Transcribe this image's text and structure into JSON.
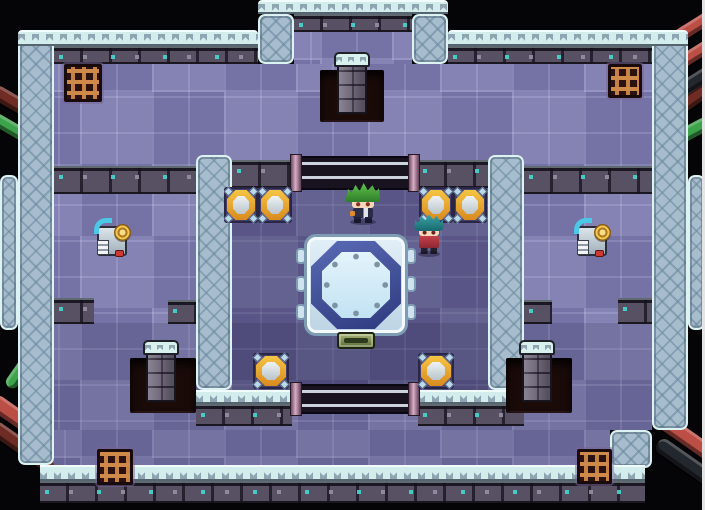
{
  "meta": {
    "width": 705,
    "height": 510
  },
  "palette": {
    "bg": "#050508",
    "wallBase": "#a7bdcd",
    "wallEdge": "#ddf2f2",
    "capBase": "#d3ecec",
    "capZig": "#8fa5b2",
    "trimBase": "#575163",
    "trimTeal": "#45d8cf",
    "trimChip": "#968fa5",
    "floorBase": "#7f7db1",
    "innerTint": "rgba(28,22,64,0.30)",
    "hallTint": "rgba(24,18,58,0.14)",
    "pillarCap": "#d8f0ee",
    "grateBar": "#cf8a4a",
    "railLine": "#ccd2de",
    "railEnd": "#d9aec6",
    "machineTube": "#49c8e8",
    "machineRed": "#cb3a33",
    "charGreenHair": "#5fc24a",
    "charTealHair": "#3fa8aa",
    "charSkin": "#f6d7b8",
    "charNavy": "#2c2c46",
    "charRed": "#c24049",
    "charOrange": "#e08a2e",
    "pipeGreen": "#3da34b",
    "pipeRed": "#bb4f46",
    "pipeRedDark": "#6e2c24",
    "pipeBlack": "#23272e"
  },
  "scene": {
    "entities": [
      {
        "name": "pipe-top-left-dark-red",
        "type": "pipe",
        "x": -12,
        "y": 100,
        "w": 70,
        "h": 15,
        "rot": 30,
        "color": "pipeRedDark",
        "inter": false
      },
      {
        "name": "pipe-top-left-green",
        "type": "pipe",
        "x": -12,
        "y": 126,
        "w": 62,
        "h": 13,
        "rot": 30,
        "color": "pipeGreen",
        "inter": false
      },
      {
        "name": "pipe-right-dark-red",
        "type": "pipe",
        "x": 650,
        "y": 95,
        "w": 70,
        "h": 16,
        "rot": -35,
        "color": "pipeRedDark",
        "inter": false
      },
      {
        "name": "pipe-right-green",
        "type": "pipe",
        "x": 664,
        "y": 126,
        "w": 48,
        "h": 14,
        "rot": -28,
        "color": "pipeGreen",
        "inter": false
      },
      {
        "name": "pipe-top-right-red-1",
        "type": "pipe",
        "x": 666,
        "y": 18,
        "w": 62,
        "h": 13,
        "rot": -32,
        "color": "pipeRed",
        "inter": false
      },
      {
        "name": "pipe-top-right-red-2",
        "type": "pipe",
        "x": 666,
        "y": 46,
        "w": 62,
        "h": 13,
        "rot": -32,
        "color": "pipeRed",
        "inter": false
      },
      {
        "name": "pipe-top-right-black",
        "type": "pipe",
        "x": 662,
        "y": 74,
        "w": 66,
        "h": 14,
        "rot": -32,
        "color": "pipeBlack",
        "inter": false
      },
      {
        "name": "pipe-bottom-left-green-1",
        "type": "pipe",
        "x": -8,
        "y": 312,
        "w": 58,
        "h": 13,
        "rot": 48,
        "color": "pipeGreen",
        "inter": false
      },
      {
        "name": "pipe-bottom-left-green-2",
        "type": "pipe",
        "x": -4,
        "y": 356,
        "w": 60,
        "h": 13,
        "rot": -55,
        "color": "pipeGreen",
        "inter": false
      },
      {
        "name": "pipe-bottom-left-red",
        "type": "pipe",
        "x": -16,
        "y": 418,
        "w": 92,
        "h": 17,
        "rot": 35,
        "color": "pipeRed",
        "inter": false
      },
      {
        "name": "pipe-bottom-left-dark-red",
        "type": "pipe",
        "x": -16,
        "y": 446,
        "w": 96,
        "h": 15,
        "rot": 35,
        "color": "pipeRedDark",
        "inter": false
      },
      {
        "name": "pipe-bottom-right-red",
        "type": "pipe",
        "x": 638,
        "y": 424,
        "w": 82,
        "h": 16,
        "rot": 35,
        "color": "pipeRed",
        "inter": false
      },
      {
        "name": "pipe-bottom-right-black",
        "type": "pipe",
        "x": 650,
        "y": 460,
        "w": 88,
        "h": 16,
        "rot": 35,
        "color": "pipeBlack",
        "inter": false
      },
      {
        "name": "outer-wall-left",
        "type": "wall",
        "x": 18,
        "y": 30,
        "w": 36,
        "h": 435,
        "inter": false
      },
      {
        "name": "outer-wall-right",
        "type": "wall",
        "x": 652,
        "y": 30,
        "w": 36,
        "h": 400,
        "inter": false
      },
      {
        "name": "outer-wall-left-bump",
        "type": "wall",
        "x": 0,
        "y": 175,
        "w": 18,
        "h": 155,
        "inter": false
      },
      {
        "name": "outer-wall-right-bump",
        "type": "wall",
        "x": 688,
        "y": 175,
        "w": 17,
        "h": 155,
        "inter": false
      },
      {
        "name": "top-bump-wall-left",
        "type": "wall",
        "x": 258,
        "y": 14,
        "w": 36,
        "h": 50,
        "inter": false
      },
      {
        "name": "top-bump-wall-right",
        "type": "wall",
        "x": 412,
        "y": 14,
        "w": 36,
        "h": 50,
        "inter": false
      },
      {
        "name": "outer-wall-step-bottom-right",
        "type": "wall",
        "x": 610,
        "y": 430,
        "w": 42,
        "h": 38,
        "inter": false
      },
      {
        "name": "top-wall-cap-left",
        "type": "cap",
        "x": 18,
        "y": 30,
        "w": 240,
        "h": 16,
        "inter": false
      },
      {
        "name": "top-wall-cap-right",
        "type": "cap",
        "x": 448,
        "y": 30,
        "w": 240,
        "h": 16,
        "inter": false
      },
      {
        "name": "top-bump-cap",
        "type": "cap",
        "x": 258,
        "y": 0,
        "w": 190,
        "h": 14,
        "inter": false
      },
      {
        "name": "top-wall-trim-left",
        "type": "trim",
        "x": 54,
        "y": 46,
        "w": 204,
        "h": 18,
        "inter": false
      },
      {
        "name": "top-wall-trim-right",
        "type": "trim",
        "x": 448,
        "y": 46,
        "w": 204,
        "h": 18,
        "inter": false
      },
      {
        "name": "top-bump-trim",
        "type": "trim",
        "x": 294,
        "y": 14,
        "w": 118,
        "h": 18,
        "inter": false
      },
      {
        "name": "top-bump-floor",
        "type": "floor",
        "x": 294,
        "y": 32,
        "w": 118,
        "h": 34,
        "inter": false
      },
      {
        "name": "main-floor-upper",
        "type": "floor",
        "x": 54,
        "y": 64,
        "w": 598,
        "h": 366,
        "inter": false
      },
      {
        "name": "main-floor-lower",
        "type": "floor",
        "x": 54,
        "y": 430,
        "w": 556,
        "h": 35,
        "inter": false
      },
      {
        "name": "bottom-wall-cap",
        "type": "capup",
        "x": 40,
        "y": 465,
        "w": 605,
        "h": 16,
        "inter": false
      },
      {
        "name": "bottom-wall-trim",
        "type": "trim",
        "x": 40,
        "y": 481,
        "w": 605,
        "h": 22,
        "inter": false
      },
      {
        "name": "inner-room-floor-tint",
        "type": "tint",
        "x": 232,
        "y": 182,
        "w": 256,
        "h": 208,
        "color": "innerTint",
        "inter": false
      },
      {
        "name": "bottom-hall-tint",
        "type": "tint",
        "x": 54,
        "y": 323,
        "w": 598,
        "h": 107,
        "color": "hallTint",
        "inter": false
      },
      {
        "name": "bottom-hall-tint-lower",
        "type": "tint",
        "x": 54,
        "y": 430,
        "w": 556,
        "h": 35,
        "color": "hallTint",
        "inter": false
      },
      {
        "name": "left-alcove-top-trim",
        "type": "trim",
        "x": 54,
        "y": 166,
        "w": 142,
        "h": 28,
        "inter": false
      },
      {
        "name": "right-alcove-top-trim",
        "type": "trim",
        "x": 524,
        "y": 166,
        "w": 128,
        "h": 28,
        "inter": false
      },
      {
        "name": "left-alcove-bottom-stub-outer",
        "type": "trim",
        "x": 54,
        "y": 298,
        "w": 40,
        "h": 26,
        "inter": false
      },
      {
        "name": "left-alcove-bottom-stub-inner",
        "type": "trim",
        "x": 168,
        "y": 300,
        "w": 28,
        "h": 24,
        "inter": false
      },
      {
        "name": "right-alcove-bottom-stub-inner",
        "type": "trim",
        "x": 524,
        "y": 300,
        "w": 28,
        "h": 24,
        "inter": false
      },
      {
        "name": "right-alcove-bottom-stub-outer",
        "type": "trim",
        "x": 618,
        "y": 298,
        "w": 34,
        "h": 26,
        "inter": false
      },
      {
        "name": "inner-room-wall-left",
        "type": "wall",
        "x": 196,
        "y": 155,
        "w": 36,
        "h": 235,
        "inter": false
      },
      {
        "name": "inner-room-wall-right",
        "type": "wall",
        "x": 488,
        "y": 155,
        "w": 36,
        "h": 235,
        "inter": false
      },
      {
        "name": "inner-room-top-trim-left",
        "type": "trim",
        "x": 232,
        "y": 160,
        "w": 60,
        "h": 28,
        "inter": false
      },
      {
        "name": "inner-room-top-trim-right",
        "type": "trim",
        "x": 418,
        "y": 160,
        "w": 70,
        "h": 28,
        "inter": false
      },
      {
        "name": "inner-room-bottom-cap-left",
        "type": "capup",
        "x": 196,
        "y": 390,
        "w": 96,
        "h": 14,
        "inter": false
      },
      {
        "name": "inner-room-bottom-trim-left",
        "type": "trim",
        "x": 196,
        "y": 404,
        "w": 96,
        "h": 22,
        "inter": false
      },
      {
        "name": "inner-room-bottom-cap-right",
        "type": "capup",
        "x": 418,
        "y": 390,
        "w": 106,
        "h": 14,
        "inter": false
      },
      {
        "name": "inner-room-bottom-trim-right",
        "type": "trim",
        "x": 418,
        "y": 404,
        "w": 106,
        "h": 22,
        "inter": false
      },
      {
        "name": "gate-rail-top",
        "type": "rail",
        "x": 292,
        "y": 156,
        "w": 126,
        "h": 34,
        "inter": true
      },
      {
        "name": "gate-rail-bottom",
        "type": "rail",
        "x": 292,
        "y": 384,
        "w": 126,
        "h": 30,
        "inter": true
      },
      {
        "name": "pit-top",
        "type": "pit",
        "x": 320,
        "y": 70,
        "w": 64,
        "h": 52,
        "inter": false
      },
      {
        "name": "pit-bottom-left",
        "type": "pit",
        "x": 130,
        "y": 358,
        "w": 66,
        "h": 55,
        "inter": false
      },
      {
        "name": "pit-bottom-right",
        "type": "pit",
        "x": 506,
        "y": 358,
        "w": 66,
        "h": 55,
        "inter": false
      },
      {
        "name": "pillar-top",
        "type": "pillar",
        "x": 337,
        "y": 52,
        "w": 30,
        "h": 62,
        "inter": false
      },
      {
        "name": "pillar-bottom-left",
        "type": "pillar",
        "x": 146,
        "y": 340,
        "w": 30,
        "h": 62,
        "inter": false
      },
      {
        "name": "pillar-bottom-right",
        "type": "pillar",
        "x": 522,
        "y": 340,
        "w": 30,
        "h": 62,
        "inter": false
      },
      {
        "name": "grate-top-left",
        "type": "grate",
        "x": 64,
        "y": 64,
        "w": 38,
        "h": 38,
        "inter": false
      },
      {
        "name": "grate-top-right",
        "type": "grate",
        "x": 608,
        "y": 64,
        "w": 34,
        "h": 34,
        "inter": false
      },
      {
        "name": "grate-bottom-left",
        "type": "grate",
        "x": 97,
        "y": 449,
        "w": 36,
        "h": 36,
        "inter": false
      },
      {
        "name": "grate-bottom-right",
        "type": "grate",
        "x": 577,
        "y": 449,
        "w": 35,
        "h": 35,
        "inter": false
      },
      {
        "name": "switch-plate-top-left-1",
        "type": "plate",
        "x": 224,
        "y": 187,
        "w": 34,
        "h": 36,
        "inter": true
      },
      {
        "name": "switch-plate-top-left-2",
        "type": "plate",
        "x": 258,
        "y": 187,
        "w": 34,
        "h": 36,
        "inter": true
      },
      {
        "name": "switch-plate-top-right-1",
        "type": "plate",
        "x": 419,
        "y": 187,
        "w": 34,
        "h": 36,
        "inter": true
      },
      {
        "name": "switch-plate-top-right-2",
        "type": "plate",
        "x": 453,
        "y": 187,
        "w": 34,
        "h": 36,
        "inter": true
      },
      {
        "name": "switch-plate-bottom-left",
        "type": "plate",
        "x": 253,
        "y": 353,
        "w": 36,
        "h": 36,
        "inter": true
      },
      {
        "name": "switch-plate-bottom-right",
        "type": "plate",
        "x": 418,
        "y": 353,
        "w": 36,
        "h": 36,
        "inter": true
      },
      {
        "name": "central-platform",
        "type": "platform",
        "x": 304,
        "y": 234,
        "w": 104,
        "h": 102,
        "inter": true
      },
      {
        "name": "machine-left",
        "type": "machine",
        "x": 95,
        "y": 220,
        "w": 36,
        "h": 38,
        "inter": true
      },
      {
        "name": "machine-right",
        "type": "machine",
        "x": 575,
        "y": 220,
        "w": 36,
        "h": 38,
        "inter": true
      },
      {
        "name": "character-green-hair",
        "type": "charGreen",
        "x": 346,
        "y": 183,
        "w": 34,
        "h": 40,
        "inter": true
      },
      {
        "name": "character-teal-hair",
        "type": "charTeal",
        "x": 414,
        "y": 213,
        "w": 30,
        "h": 42,
        "inter": true
      },
      {
        "name": "screen-edge-right",
        "type": "edge",
        "x": 702,
        "y": 0,
        "w": 3,
        "h": 510,
        "inter": false
      }
    ]
  }
}
